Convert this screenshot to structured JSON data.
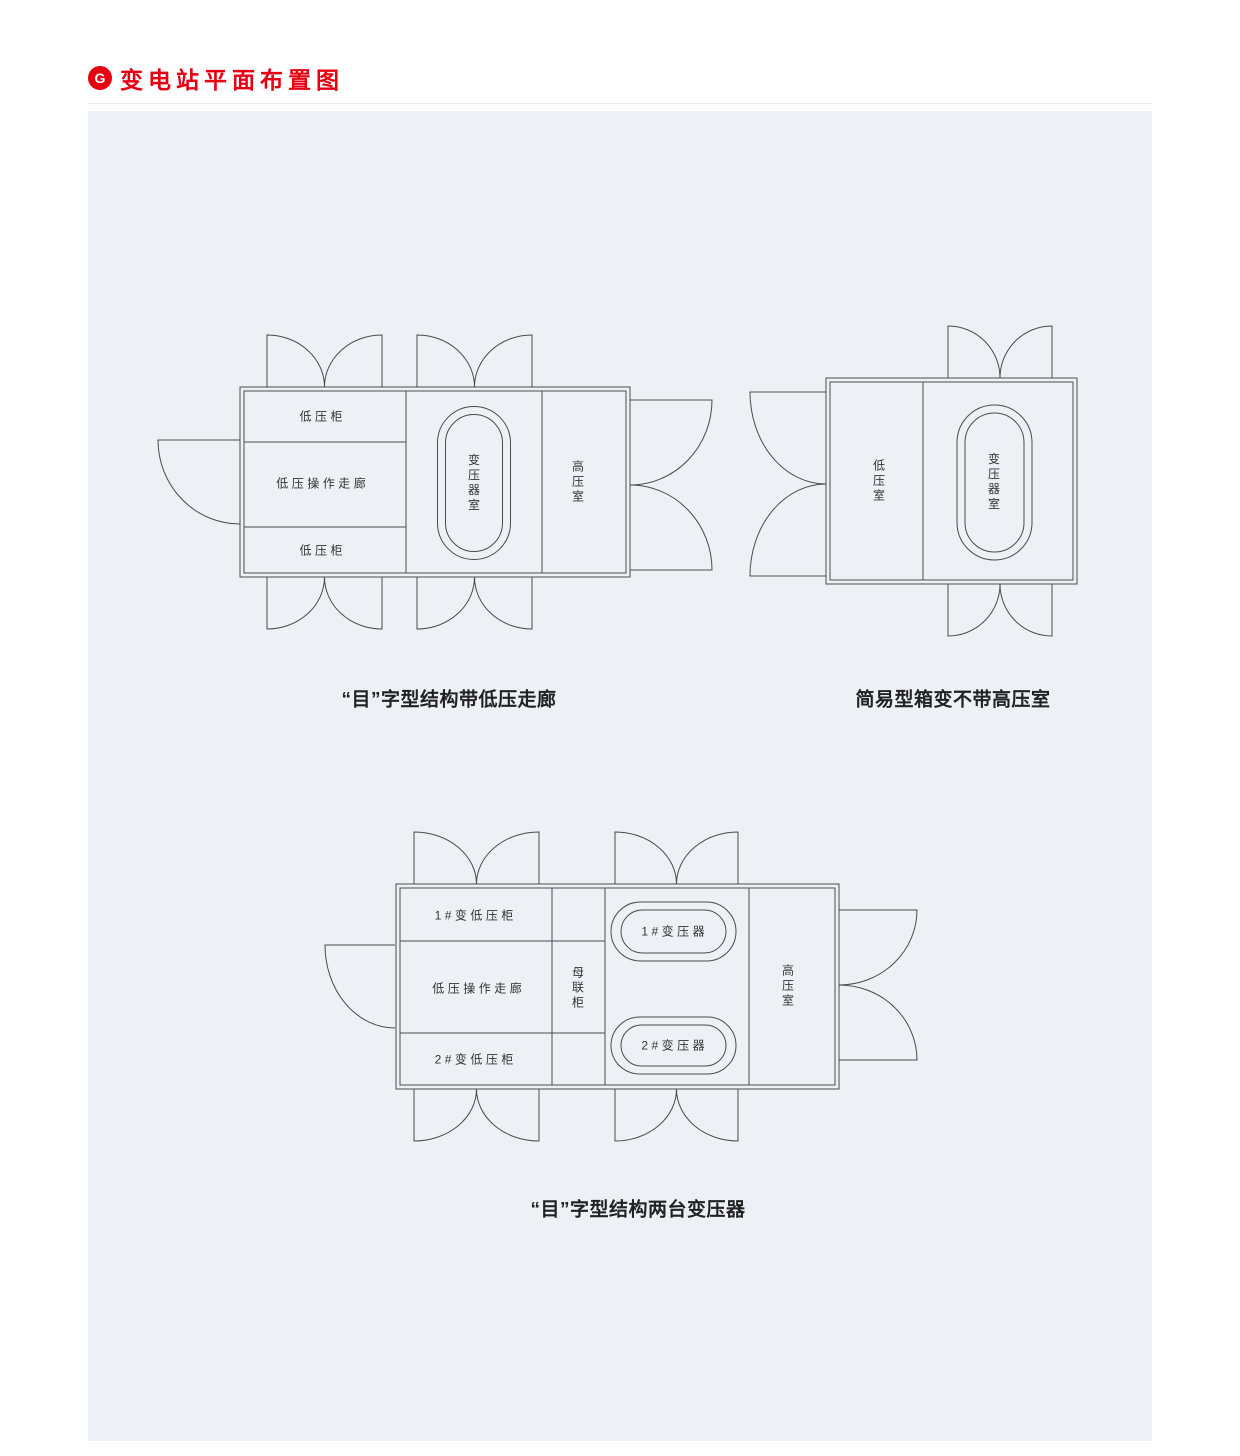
{
  "header": {
    "icon_glyph": "G",
    "title": "变电站平面布置图"
  },
  "diagram_a": {
    "caption": "“目”字型结构带低压走廊",
    "labels": {
      "lv_cabinet_top": "低压柜",
      "lv_corridor": "低压操作走廊",
      "lv_cabinet_bottom": "低压柜",
      "transformer_room": "变压器室",
      "hv_room": "高压室"
    }
  },
  "diagram_b": {
    "caption": "简易型箱变不带高压室",
    "labels": {
      "lv_room": "低压室",
      "transformer_room": "变压器室"
    }
  },
  "diagram_c": {
    "caption": "“目”字型结构两台变压器",
    "labels": {
      "t1_lv_cabinet": "1#变低压柜",
      "lv_corridor": "低压操作走廊",
      "t2_lv_cabinet": "2#变低压柜",
      "bus_tie_cabinet": "母联柜",
      "transformer_1": "1#变压器",
      "transformer_2": "2#变压器",
      "hv_room": "高压室"
    }
  },
  "colors": {
    "accent_red": "#e60012",
    "panel_bg": "#edf1f5",
    "line": "#4a4a4a"
  }
}
